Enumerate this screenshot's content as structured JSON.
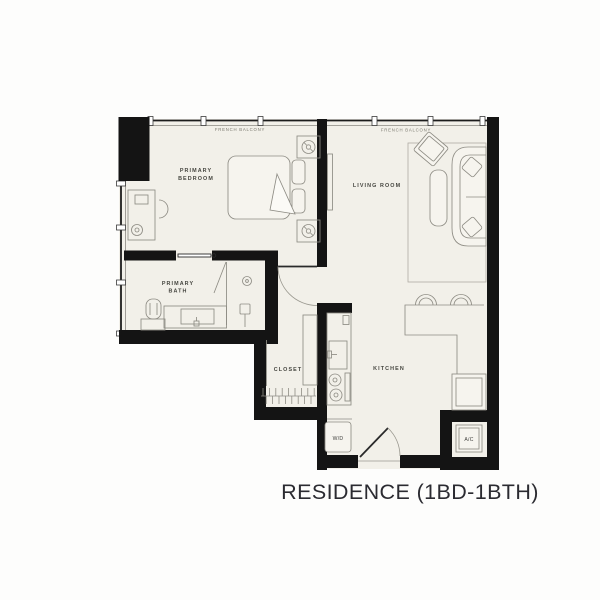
{
  "title": "RESIDENCE (1BD-1BTH)",
  "labels": {
    "french_balcony_left": "FRENCH BALCONY",
    "french_balcony_right": "FRENCH BALCONY",
    "primary_bedroom_line1": "PRIMARY",
    "primary_bedroom_line2": "BEDROOM",
    "living_room": "LIVING ROOM",
    "primary_bath_line1": "PRIMARY",
    "primary_bath_line2": "BATH",
    "closet": "CLOSET",
    "kitchen": "KITCHEN",
    "washer_dryer": "W/D",
    "ac": "A/C"
  },
  "colors": {
    "wall": "#141414",
    "floor": "#f2f0e9",
    "furniture_line": "#8e8c84",
    "room_label": "#45453f",
    "balcony_label": "#7b796f",
    "title": "#2b2b31",
    "background": "#fdfdfc"
  }
}
